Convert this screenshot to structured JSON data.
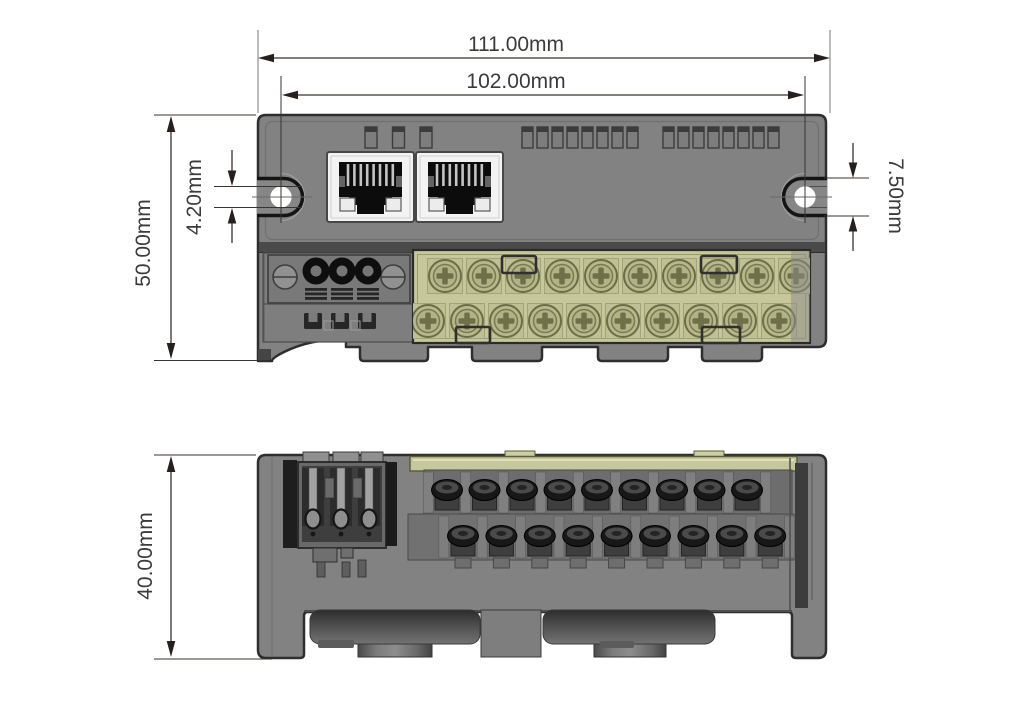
{
  "drawing": {
    "kind": "mechanical-dimension-drawing",
    "unit": "mm"
  },
  "dimensions": {
    "overall_width": "111.00mm",
    "mounting_hole_spacing": "102.00mm",
    "front_height": "50.00mm",
    "mounting_slot_width": "4.20mm",
    "mounting_ear_slot_height": "7.50mm",
    "side_height": "40.00mm"
  },
  "front_view": {
    "vent_slot_groups": [
      3,
      8,
      8
    ],
    "ethernet_ports": 2,
    "power_poles": 3,
    "power_clips": 3,
    "terminal_screws_top_row": 10,
    "terminal_screws_bottom_row": 10
  },
  "side_view": {
    "terminal_screws_top_row": 9,
    "terminal_screws_bottom_row": 9,
    "connector_pins": 3
  },
  "colors": {
    "body_gray": "#828282",
    "outline": "#2e2e2e",
    "terminal_block": "#c6c79b",
    "terminal_screw": "#b7b88c",
    "screw_cross": "#6e7049",
    "dimension_line": "#39332f",
    "dimension_text": "#3b3b3b",
    "background": "#ffffff"
  }
}
